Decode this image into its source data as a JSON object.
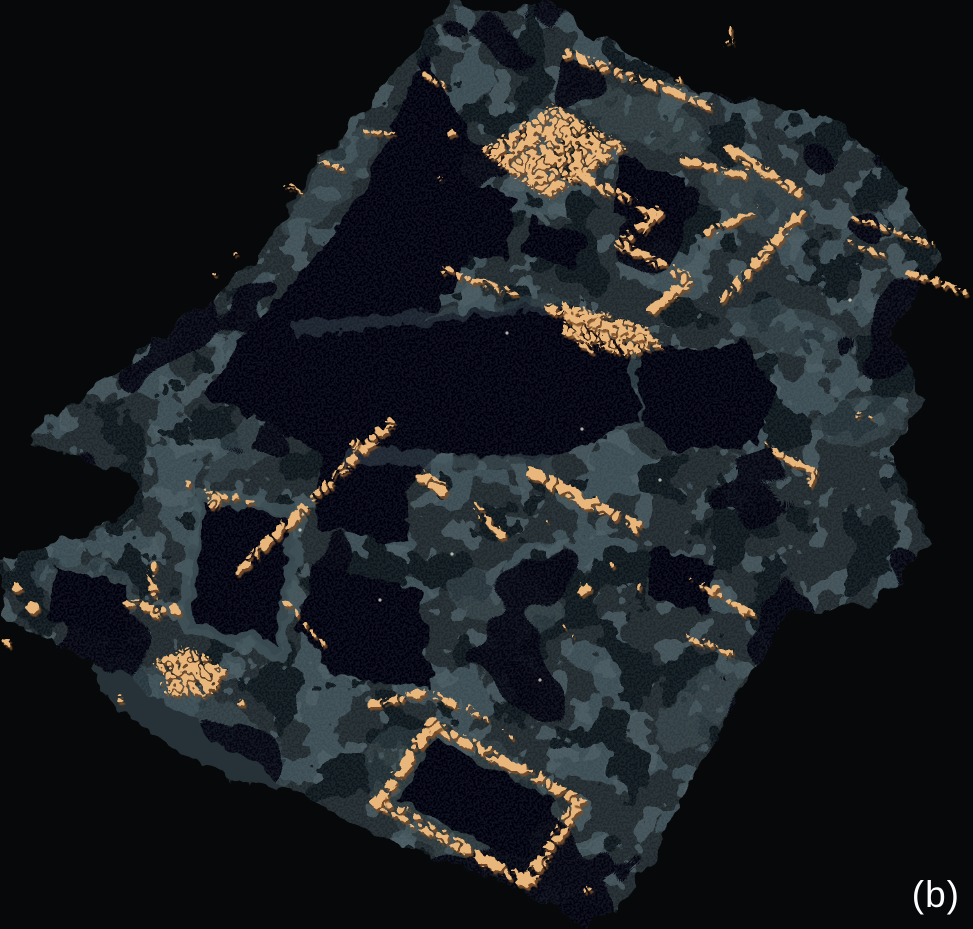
{
  "figure": {
    "label": "(b)"
  },
  "palette": {
    "background": "#06080a",
    "terrain_base": "#202a2e",
    "terrain_light": "#3e4e55",
    "terrain_light2": "#4b5c63",
    "terrain_dark": "#10161a",
    "terrain_hole": "#040608",
    "terrain_ridge": "#46575e",
    "grain": "#7f9097",
    "wall_orange": "#e9b77c",
    "wall_shadow": "#7a4e2c",
    "speck_white": "#e8e4d8",
    "label_color": "#ffffff"
  },
  "scene": {
    "terrain_outline": "M452,0 L505,12 L548,0 L575,22 L610,42 L660,72 L700,92 L745,101 L792,108 L838,120 L884,162 L912,206 L940,262 L916,300 L892,332 L924,396 L888,452 L914,505 L928,547 L898,580 L876,602 L786,615 L755,668 L736,700 L710,745 L692,782 L668,826 L648,868 L628,895 L612,912 L585,926 L552,906 L505,884 L452,862 L400,845 L358,828 L300,794 L256,766 L205,730 L150,692 L100,665 L60,644 L25,628 L2,614 L2,556 L45,545 L92,533 L126,514 L142,492 L130,472 L90,462 L52,450 L30,442 L45,420 L80,398 L115,372 L150,345 L185,320 L222,292 L252,262 L278,228 L300,195 L322,162 L350,125 L385,82 L420,45 Z",
    "lakes": [
      "M425,55 L468,135 L452,200 L470,258 L440,305 L380,350 L300,390 L250,420 L205,395 L240,340 L282,295 L322,245 L362,190 L396,120 Z",
      "M252,346 L340,330 L420,317 L562,304 L628,353 L641,422 L545,462 L430,446 L332,463 L263,420 Z",
      "M203,497 L296,514 L280,650 L184,626 Z",
      "M437,740 L557,801 L518,863 L397,801 Z",
      "M313,563 L421,593 L431,687 L335,679 L299,626 Z",
      "M437,163 L518,198 L503,262 L432,238 Z",
      "M618,153 L687,178 L677,232 L612,214 Z",
      "M652,544 L715,567 L705,614 L649,597 Z",
      "M530,216 L584,236 L574,271 L524,250 Z",
      "M55,565 L130,585 L120,640 L50,620 Z",
      "M318,445 L412,462 L405,545 L315,525 Z",
      "M640,352 L745,340 L775,395 L760,445 L672,452 L642,420 Z"
    ],
    "light_blobs": [
      {
        "x": 615,
        "y": 400,
        "rx": 72,
        "ry": 36,
        "rot": -18,
        "op": 0.6
      },
      {
        "x": 433,
        "y": 396,
        "rx": 44,
        "ry": 26,
        "rot": -15,
        "op": 0.5
      },
      {
        "x": 195,
        "y": 722,
        "rx": 115,
        "ry": 34,
        "rot": 31,
        "op": 0.6
      },
      {
        "x": 760,
        "y": 200,
        "rx": 62,
        "ry": 28,
        "rot": 22,
        "op": 0.55
      },
      {
        "x": 858,
        "y": 420,
        "rx": 48,
        "ry": 24,
        "rot": -10,
        "op": 0.5
      },
      {
        "x": 330,
        "y": 180,
        "rx": 70,
        "ry": 22,
        "rot": -52,
        "op": 0.5
      },
      {
        "x": 505,
        "y": 600,
        "rx": 58,
        "ry": 28,
        "rot": 15,
        "op": 0.55
      },
      {
        "x": 700,
        "y": 705,
        "rx": 55,
        "ry": 26,
        "rot": -48,
        "op": 0.55
      },
      {
        "x": 468,
        "y": 800,
        "rx": 112,
        "ry": 60,
        "rot": 28,
        "op": 0.4
      },
      {
        "x": 85,
        "y": 585,
        "rx": 55,
        "ry": 26,
        "rot": 15,
        "op": 0.6
      },
      {
        "x": 790,
        "y": 330,
        "rx": 66,
        "ry": 24,
        "rot": 18,
        "op": 0.5
      },
      {
        "x": 640,
        "y": 120,
        "rx": 70,
        "ry": 26,
        "rot": 20,
        "op": 0.45
      },
      {
        "x": 250,
        "y": 440,
        "rx": 60,
        "ry": 20,
        "rot": -40,
        "op": 0.5
      }
    ],
    "light_ridges": [
      {
        "d": "M200,494 L298,512 L282,651 L184,627 Z",
        "w": 13,
        "op": 0.8
      },
      {
        "d": "M350,456 L545,465",
        "w": 16,
        "op": 0.45
      },
      {
        "d": "M300,330 L560,303",
        "w": 13,
        "op": 0.4
      }
    ],
    "walls": [
      {
        "d": "M567,52 L706,103",
        "w": 9,
        "dash": "22 7 14 9"
      },
      {
        "d": "M575,172 L655,212 L618,242 L688,277 L650,307",
        "w": 10
      },
      {
        "d": "M437,266 L512,292",
        "w": 6,
        "dash": "26 6"
      },
      {
        "d": "M548,306 L636,334",
        "w": 11
      },
      {
        "d": "M566,330 L592,348",
        "w": 7
      },
      {
        "d": "M680,158 L748,174",
        "w": 7,
        "dash": "18 6"
      },
      {
        "d": "M705,231 L753,207",
        "w": 7
      },
      {
        "d": "M726,146 L796,190",
        "w": 10,
        "dash": "16 6"
      },
      {
        "d": "M798,212 L722,296",
        "w": 9,
        "dash": "20 6"
      },
      {
        "d": "M850,215 L928,241",
        "w": 4,
        "dash": "7 8"
      },
      {
        "d": "M906,270 L962,289",
        "w": 6
      },
      {
        "d": "M845,241 L884,254",
        "w": 4,
        "dash": "5 7"
      },
      {
        "d": "M388,420 L310,497",
        "w": 9,
        "dash": "30 8"
      },
      {
        "d": "M302,505 L231,573",
        "w": 9,
        "dash": "24 9"
      },
      {
        "d": "M530,470 L634,524",
        "w": 13
      },
      {
        "d": "M472,503 L499,533",
        "w": 8
      },
      {
        "d": "M420,472 L441,488",
        "w": 11
      },
      {
        "d": "M690,578 L750,612",
        "w": 5,
        "dash": "10 6"
      },
      {
        "d": "M775,452 L812,468 L808,482",
        "w": 5
      },
      {
        "d": "M762,441 L791,462",
        "w": 4,
        "dash": "6 5"
      },
      {
        "d": "M283,600 L327,647",
        "w": 4,
        "dash": "6 7"
      },
      {
        "d": "M150,563 L154,612",
        "w": 8
      },
      {
        "d": "M127,601 L176,608",
        "w": 8
      },
      {
        "d": "M368,702 L425,690 L475,712",
        "w": 7,
        "dash": "14 7"
      },
      {
        "d": "M430,722 L577,798 L525,880 L377,800 Z",
        "w": 11
      },
      {
        "d": "M683,634 L731,651",
        "w": 5,
        "dash": "8 5"
      },
      {
        "d": "M728,25 L729,39",
        "w": 3
      },
      {
        "d": "M677,76 L679,86",
        "w": 3
      },
      {
        "d": "M313,155 L341,167",
        "w": 4
      },
      {
        "d": "M360,128 L394,133",
        "w": 3,
        "dash": "7 5"
      },
      {
        "d": "M422,72 L441,83",
        "w": 4
      },
      {
        "d": "M283,183 L301,190",
        "w": 3
      },
      {
        "d": "M203,490 L252,500",
        "w": 4,
        "dash": "6 8"
      }
    ],
    "wall_fills": [
      "M478,148 L553,103 L625,145 L545,195 Z",
      "M152,660 L185,644 L224,668 L206,694 L164,691 Z",
      "M560,300 L640,322 L660,345 L620,352 L560,330 Z"
    ],
    "orange_dots": [
      [
        725,
        42,
        3
      ],
      [
        352,
        441,
        5
      ],
      [
        583,
        587,
        6
      ],
      [
        563,
        623,
        2
      ],
      [
        571,
        634,
        2
      ],
      [
        14,
        585,
        5
      ],
      [
        30,
        606,
        6
      ],
      [
        6,
        640,
        4
      ],
      [
        118,
        697,
        3
      ],
      [
        240,
        700,
        3
      ],
      [
        483,
        718,
        2
      ],
      [
        500,
        728,
        2
      ],
      [
        509,
        734,
        2
      ],
      [
        740,
        607,
        6
      ],
      [
        713,
        586,
        4
      ],
      [
        586,
        887,
        3
      ],
      [
        545,
        520,
        2
      ],
      [
        610,
        562,
        3
      ],
      [
        637,
        585,
        3
      ],
      [
        450,
        130,
        3
      ],
      [
        437,
        176,
        3
      ],
      [
        212,
        500,
        6
      ],
      [
        186,
        481,
        3
      ],
      [
        430,
        722,
        8
      ],
      [
        577,
        798,
        7
      ],
      [
        525,
        880,
        7
      ],
      [
        377,
        800,
        8
      ],
      [
        233,
        252,
        3
      ],
      [
        214,
        272,
        2
      ],
      [
        917,
        238,
        2
      ],
      [
        893,
        228,
        2
      ],
      [
        857,
        413,
        2
      ],
      [
        868,
        416,
        2
      ]
    ],
    "white_specks": [
      [
        507,
        333
      ],
      [
        582,
        429
      ],
      [
        452,
        554
      ],
      [
        300,
        530
      ],
      [
        660,
        480
      ],
      [
        850,
        300
      ],
      [
        540,
        680
      ],
      [
        380,
        600
      ]
    ]
  }
}
